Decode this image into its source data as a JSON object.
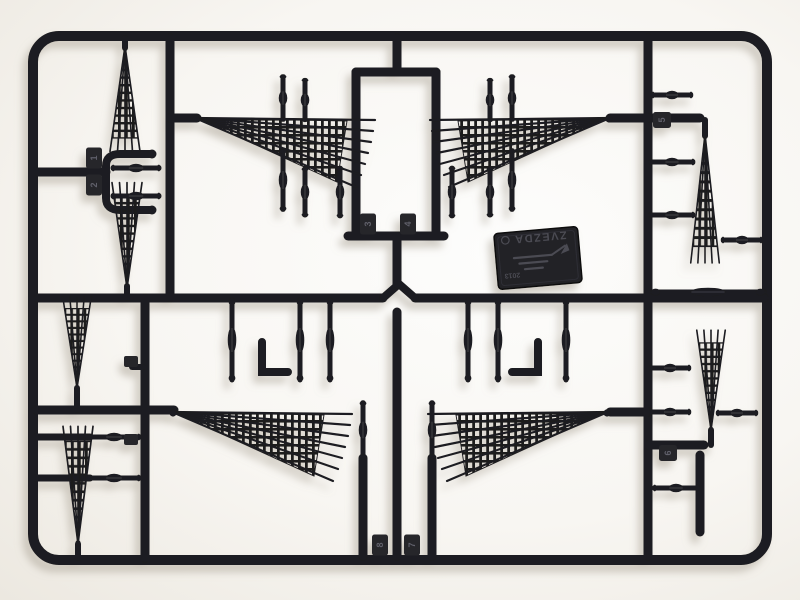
{
  "scene": {
    "subject": "black plastic model-kit sprue (parts tree) with ship rigging parts on white background",
    "colors": {
      "plastic": "#1d1d20",
      "plastic_highlight": "#3e3e46",
      "emboss": "#4b4b53",
      "background": "#f7f5f1",
      "shadow": "#a59c8e"
    },
    "brand_plate": {
      "brand": "ZVEZDA",
      "year": "2013"
    },
    "part_tabs": [
      {
        "label": "1"
      },
      {
        "label": "2"
      },
      {
        "label": "3"
      },
      {
        "label": "4"
      },
      {
        "label": "5"
      },
      {
        "label": "6"
      },
      {
        "label": "7"
      },
      {
        "label": "8"
      }
    ]
  }
}
